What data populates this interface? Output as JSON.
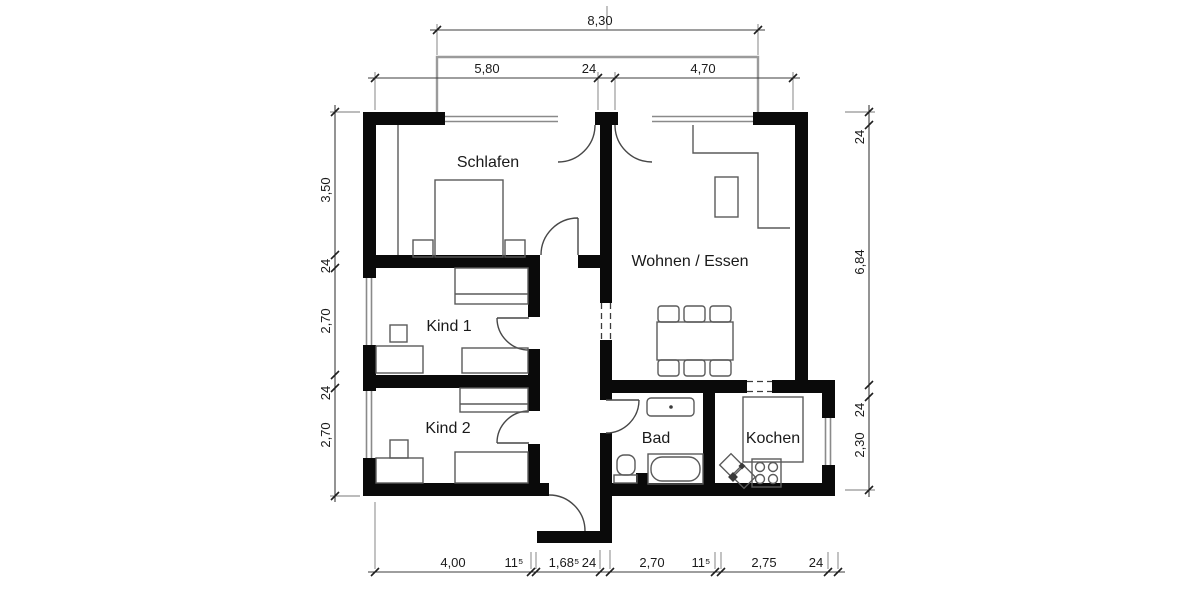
{
  "rooms": {
    "schlafen": "Schlafen",
    "wohnen": "Wohnen / Essen",
    "kind1": "Kind 1",
    "kind2": "Kind 2",
    "bad": "Bad",
    "kochen": "Kochen"
  },
  "dims": {
    "top_total": "8,30",
    "top": [
      "5,80",
      "24",
      "4,70"
    ],
    "left": [
      "3,50",
      "24",
      "2,70",
      "24",
      "2,70"
    ],
    "right": [
      "24",
      "6,84",
      "24",
      "2,30"
    ],
    "bottom": [
      "4,00",
      "11⁵",
      "1,68⁵",
      "24",
      "2,70",
      "11⁵",
      "2,75",
      "24"
    ]
  },
  "colors": {
    "wall": "#0a0a0a",
    "furniture_line": "#5a5a5a",
    "dimension_line": "#3c3c3c",
    "glazing": "#8a8a8a",
    "text": "#1a1a1a",
    "background": "#ffffff"
  }
}
